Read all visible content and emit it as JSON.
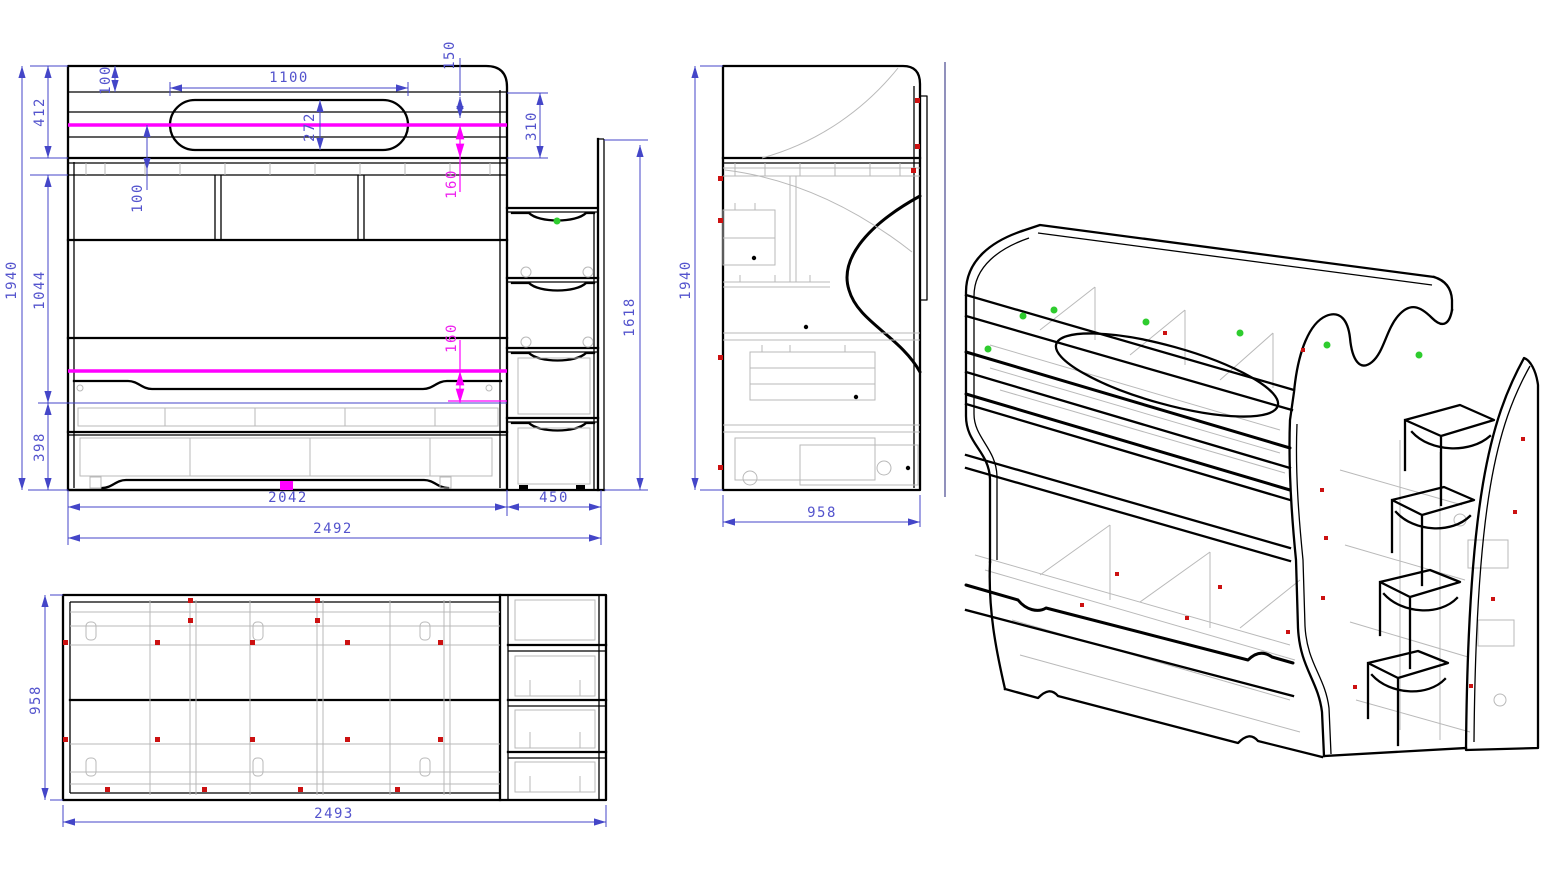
{
  "drawing": {
    "type": "furniture-technical-drawing",
    "subject": "bunk bed with stair drawers",
    "colors": {
      "dimension_blue": "#4446c8",
      "magenta": "#ff00ff",
      "hidden_gray": "#b9b9b9",
      "outline_black": "#000000",
      "fastener_red": "#cc1111",
      "fastener_green": "#2ecc2e"
    },
    "views": {
      "front": {
        "label": "front-elevation",
        "dims": {
          "total_height": "1940",
          "upper_section_height": "412",
          "middle_section_height": "1044",
          "lower_section_height": "398",
          "top_rail_inset": "100",
          "rail_spacing": "100",
          "cutout_width": "1100",
          "cutout_height": "272",
          "top_corner_offset": "150",
          "rail_band_height": "310",
          "upper_mattress_gap": "160",
          "lower_mattress_gap": "160",
          "bed_width": "2042",
          "ladder_width": "450",
          "overall_width": "2492",
          "ladder_height": "1618"
        }
      },
      "side": {
        "label": "side-elevation",
        "dims": {
          "total_height": "1940",
          "depth": "958"
        }
      },
      "plan": {
        "label": "plan-view",
        "dims": {
          "depth": "958",
          "overall_width": "2493"
        }
      },
      "iso": {
        "label": "isometric-view"
      }
    }
  }
}
